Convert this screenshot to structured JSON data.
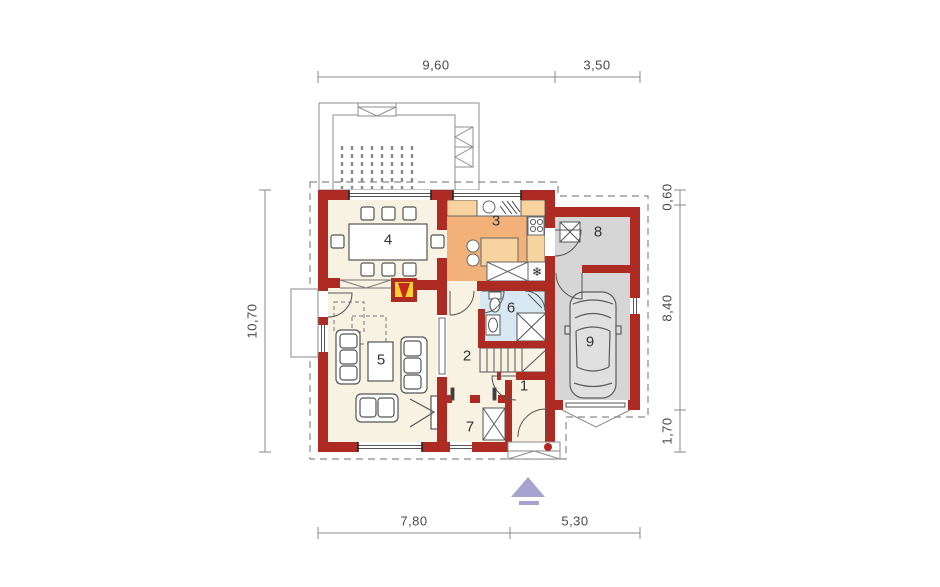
{
  "plan": {
    "rooms": [
      {
        "number": "1"
      },
      {
        "number": "2"
      },
      {
        "number": "3"
      },
      {
        "number": "4"
      },
      {
        "number": "5"
      },
      {
        "number": "6"
      },
      {
        "number": "7"
      },
      {
        "number": "8"
      },
      {
        "number": "9"
      }
    ],
    "dimensions": {
      "top": [
        "9,60",
        "3,50"
      ],
      "bottom": [
        "7,80",
        "5,30"
      ],
      "left": [
        "10,70"
      ],
      "right": [
        "0,60",
        "8,40",
        "1,70"
      ]
    },
    "symbols": {
      "fridge": "❄"
    },
    "colors": {
      "wall": "#ae2b24",
      "floor_cream": "#f8f2e3",
      "kitchen_floor": "#f2b179",
      "kitchen_counter": "#f7d3a0",
      "bathroom_floor": "#d7e8f3",
      "garage_floor": "#d6d6d6",
      "car_fill": "#e0e0e0",
      "fireplace_accent": "#f5d12f",
      "north_arrow": "#a8a2cf",
      "dimension_line": "#8a8a8a",
      "dimension_text": "#4a4a4a"
    }
  }
}
